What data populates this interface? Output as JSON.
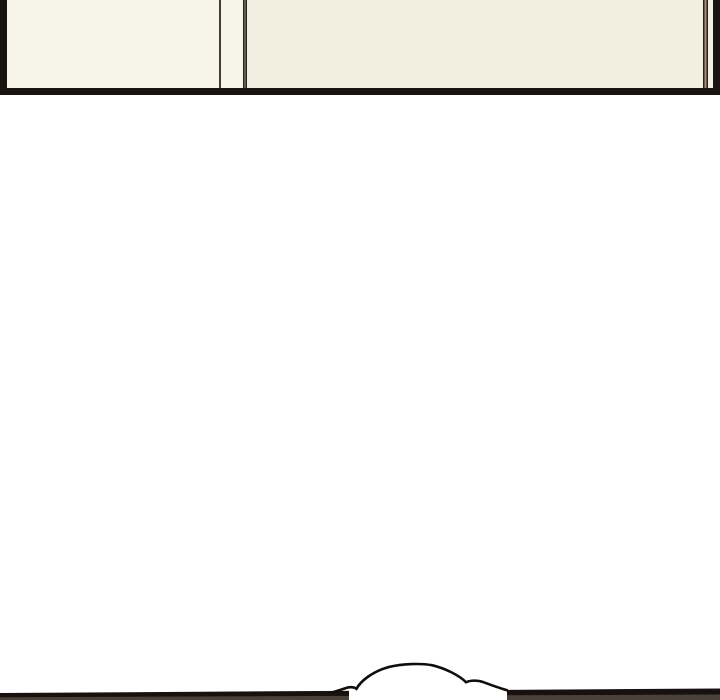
{
  "scene": {
    "kind": "webtoon-comic-strip-segment",
    "top_panel": "bottom edge of a cream room-interior panel with wall and door-frame lines",
    "gutter": "blank white spacing between panels",
    "bottom_panel": "top edge of next panel with a thought-bubble cloud overlapping it"
  },
  "colors": {
    "page_background": "#ffffff",
    "panel_border": "#191411",
    "cream_left": "#f7f4ea",
    "cream_mid": "#f5f1e6",
    "cream_right": "#f2eee0",
    "wall_line_single": "#473c32",
    "wall_line_dark": "#2b231c",
    "wall_line_light": "#a3917e",
    "bar_black": "#171210",
    "bar_inner": "#4a413a",
    "bubble_fill": "#ffffff",
    "bubble_stroke": "#100d0b"
  }
}
